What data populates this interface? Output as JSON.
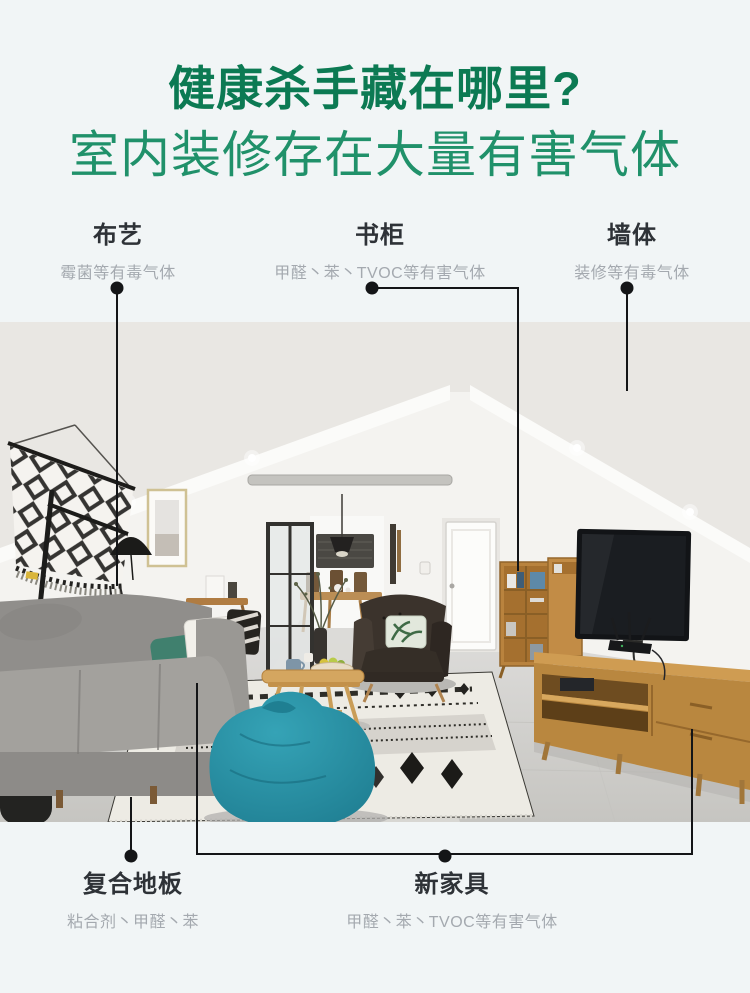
{
  "header": {
    "title": "健康杀手藏在哪里?",
    "subtitle": "室内装修存在大量有害气体"
  },
  "callouts": {
    "top": [
      {
        "label": "布艺",
        "desc": "霉菌等有毒气体"
      },
      {
        "label": "书柜",
        "desc": "甲醛丶苯丶TVOC等有害气体"
      },
      {
        "label": "墙体",
        "desc": "装修等有毒气体"
      }
    ],
    "bottom": [
      {
        "label": "复合地板",
        "desc": "粘合剂丶甲醛丶苯"
      },
      {
        "label": "新家具",
        "desc": "甲醛丶苯丶TVOC等有害气体"
      }
    ]
  },
  "colors": {
    "title_green": "#0c7a53",
    "subtitle_green": "#20916a",
    "label_text": "#2e3237",
    "desc_text": "#a4a9af",
    "connector_black": "#141517",
    "beanbag_teal": "#2a96ab",
    "wood_tone": "#bd8942",
    "page_background": "#f1f5f6"
  }
}
